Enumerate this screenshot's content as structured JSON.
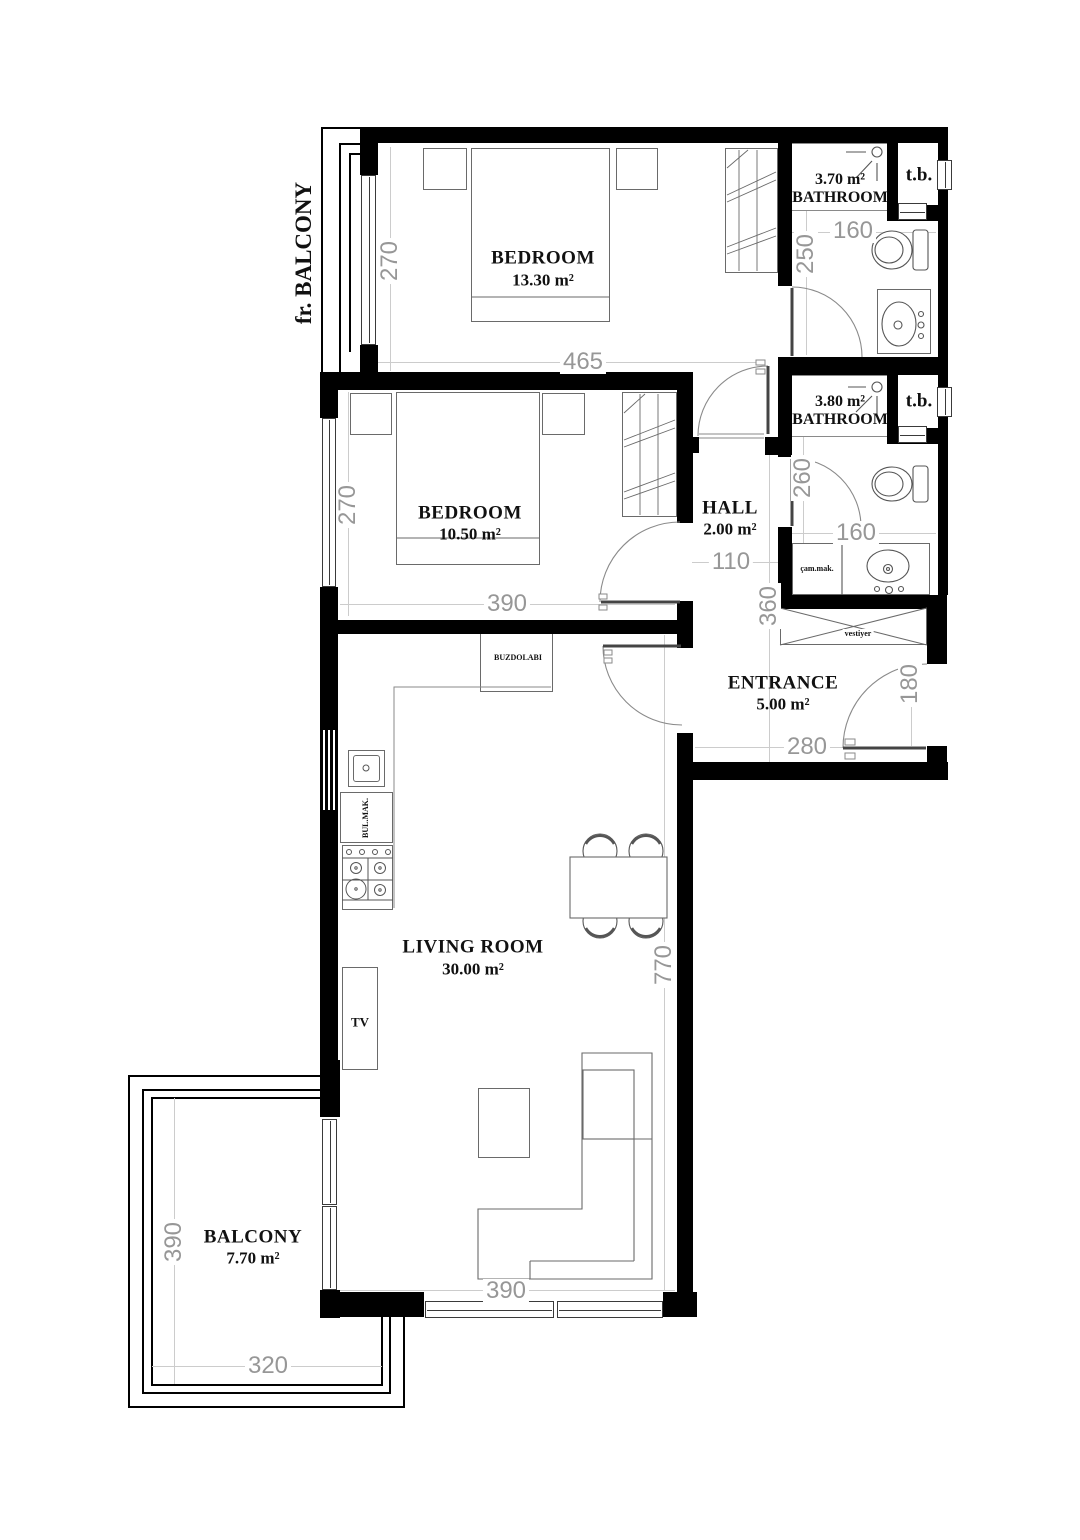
{
  "colors": {
    "wall": "#000000",
    "furniture_line": "#6a6a6a",
    "dim_text": "#979797",
    "label_text": "#111111"
  },
  "rooms": {
    "french_balcony": {
      "name": "fr. BALCONY"
    },
    "bedroom1": {
      "name": "BEDROOM",
      "area": "13.30 m²",
      "dim_width": "465",
      "dim_height": "270"
    },
    "bathroom1": {
      "name": "BATHROOM",
      "area": "3.70 m²",
      "dim_width": "160",
      "dim_height": "250",
      "shaft_label": "t.b."
    },
    "bedroom2": {
      "name": "BEDROOM",
      "area": "10.50 m²",
      "dim_width": "390",
      "dim_height": "270"
    },
    "bathroom2": {
      "name": "BATHROOM",
      "area": "3.80 m²",
      "dim_width": "160",
      "dim_height": "260",
      "shaft_label": "t.b."
    },
    "hall": {
      "name": "HALL",
      "area": "2.00 m²",
      "dim_width": "110",
      "dim_height": "360"
    },
    "entrance": {
      "name": "ENTRANCE",
      "area": "5.00 m²",
      "dim_width": "280",
      "dim_door": "180"
    },
    "living_room": {
      "name": "LIVING ROOM",
      "area": "30.00 m²",
      "dim_width": "390",
      "dim_height": "770"
    },
    "balcony": {
      "name": "BALCONY",
      "area": "7.70 m²",
      "dim_width": "320",
      "dim_height": "390"
    }
  },
  "appliances": {
    "fridge": "BUZDOLABI",
    "dishwasher": "BUL.MAK.",
    "washing_machine": "çam.mak.",
    "coat_closet": "vestiyer",
    "tv": "TV"
  }
}
